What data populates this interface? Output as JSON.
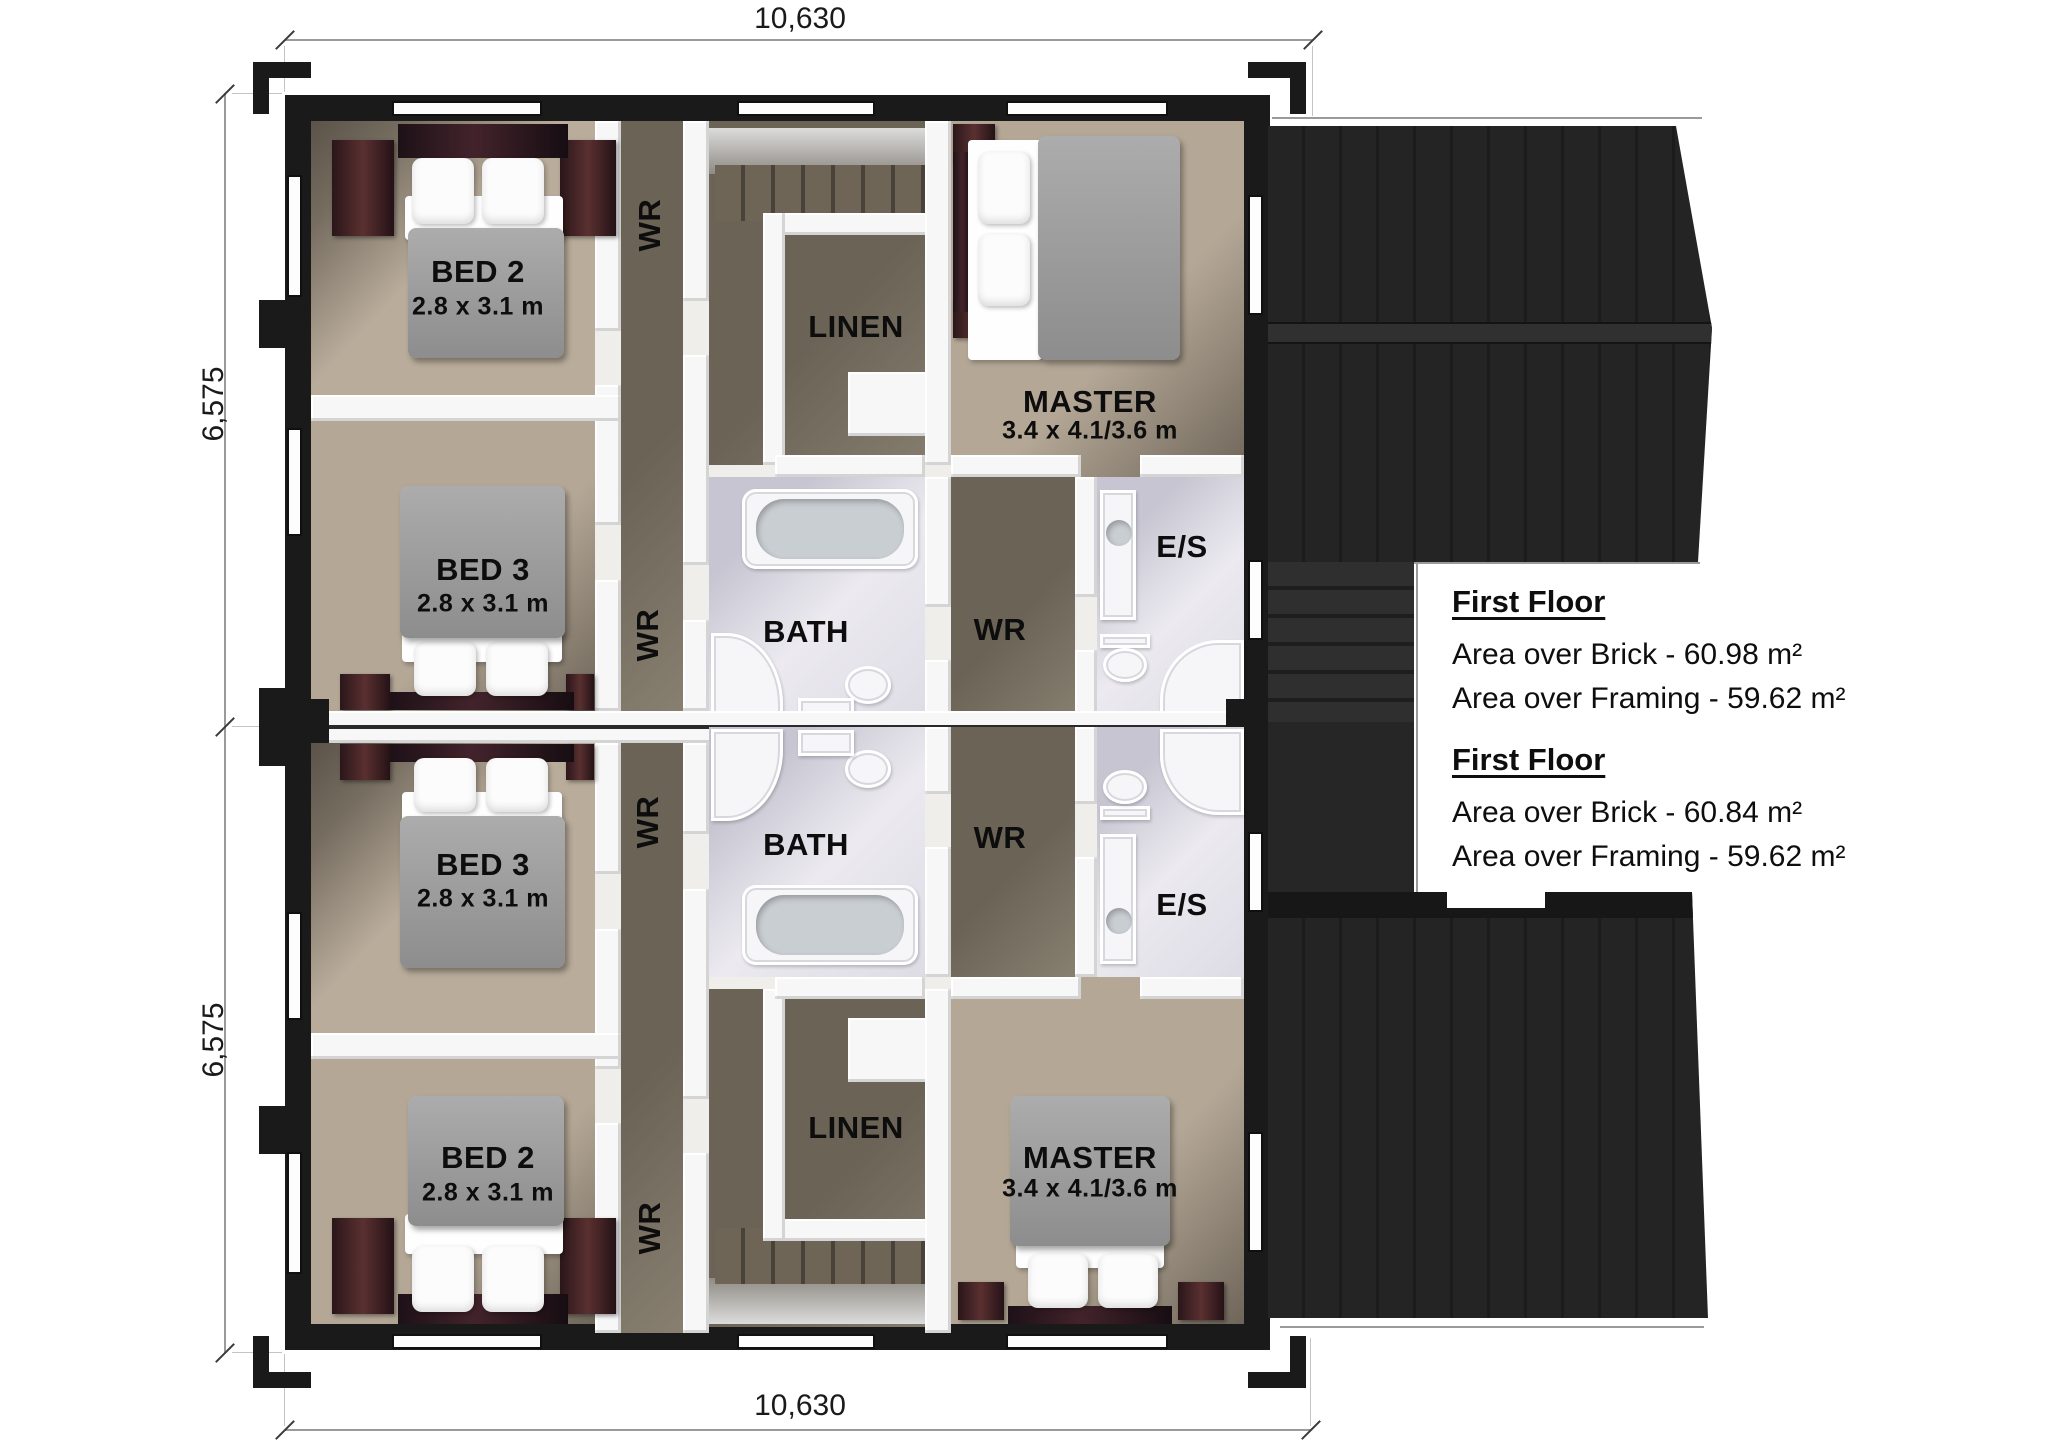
{
  "drawing": {
    "type": "first-floor duplex plan, 3d rendered"
  },
  "dimensions": {
    "top": "10,630",
    "bottom": "10,630",
    "left_upper": "6,575",
    "left_lower": "6,575"
  },
  "annotations": [
    {
      "title": "First Floor",
      "lines": [
        "Area over Brick - 60.98 m²",
        "Area over Framing - 59.62 m²"
      ]
    },
    {
      "title": "First Floor",
      "lines": [
        "Area over Brick - 60.84 m²",
        "Area over Framing - 59.62 m²"
      ]
    }
  ],
  "units": [
    {
      "id": "unit-a",
      "rooms": [
        {
          "label": "BED 2",
          "size": "2.8 x 3.1 m"
        },
        {
          "label": "WR"
        },
        {
          "label": "LINEN"
        },
        {
          "label": "MASTER",
          "size": "3.4 x 4.1/3.6 m"
        },
        {
          "label": "BED 3",
          "size": "2.8 x 3.1 m"
        },
        {
          "label": "WR"
        },
        {
          "label": "BATH"
        },
        {
          "label": "WR"
        },
        {
          "label": "E/S"
        }
      ]
    },
    {
      "id": "unit-b",
      "rooms": [
        {
          "label": "BED 2",
          "size": "2.8 x 3.1 m"
        },
        {
          "label": "WR"
        },
        {
          "label": "LINEN"
        },
        {
          "label": "MASTER",
          "size": "3.4 x 4.1/3.6 m"
        },
        {
          "label": "BED 3",
          "size": "2.8 x 3.1 m"
        },
        {
          "label": "WR"
        },
        {
          "label": "BATH"
        },
        {
          "label": "WR"
        },
        {
          "label": "E/S"
        }
      ]
    }
  ],
  "colors": {
    "wall": "#1a1a1a",
    "interior_wall": "#f7f7f7",
    "carpet": "#b9ac9b",
    "carpet_shadow": "#6b6356",
    "bath_floor": "#dddbe4",
    "roof": "#242424",
    "dimension_line": "#9a9a9a",
    "text": "#0d0d0d"
  }
}
